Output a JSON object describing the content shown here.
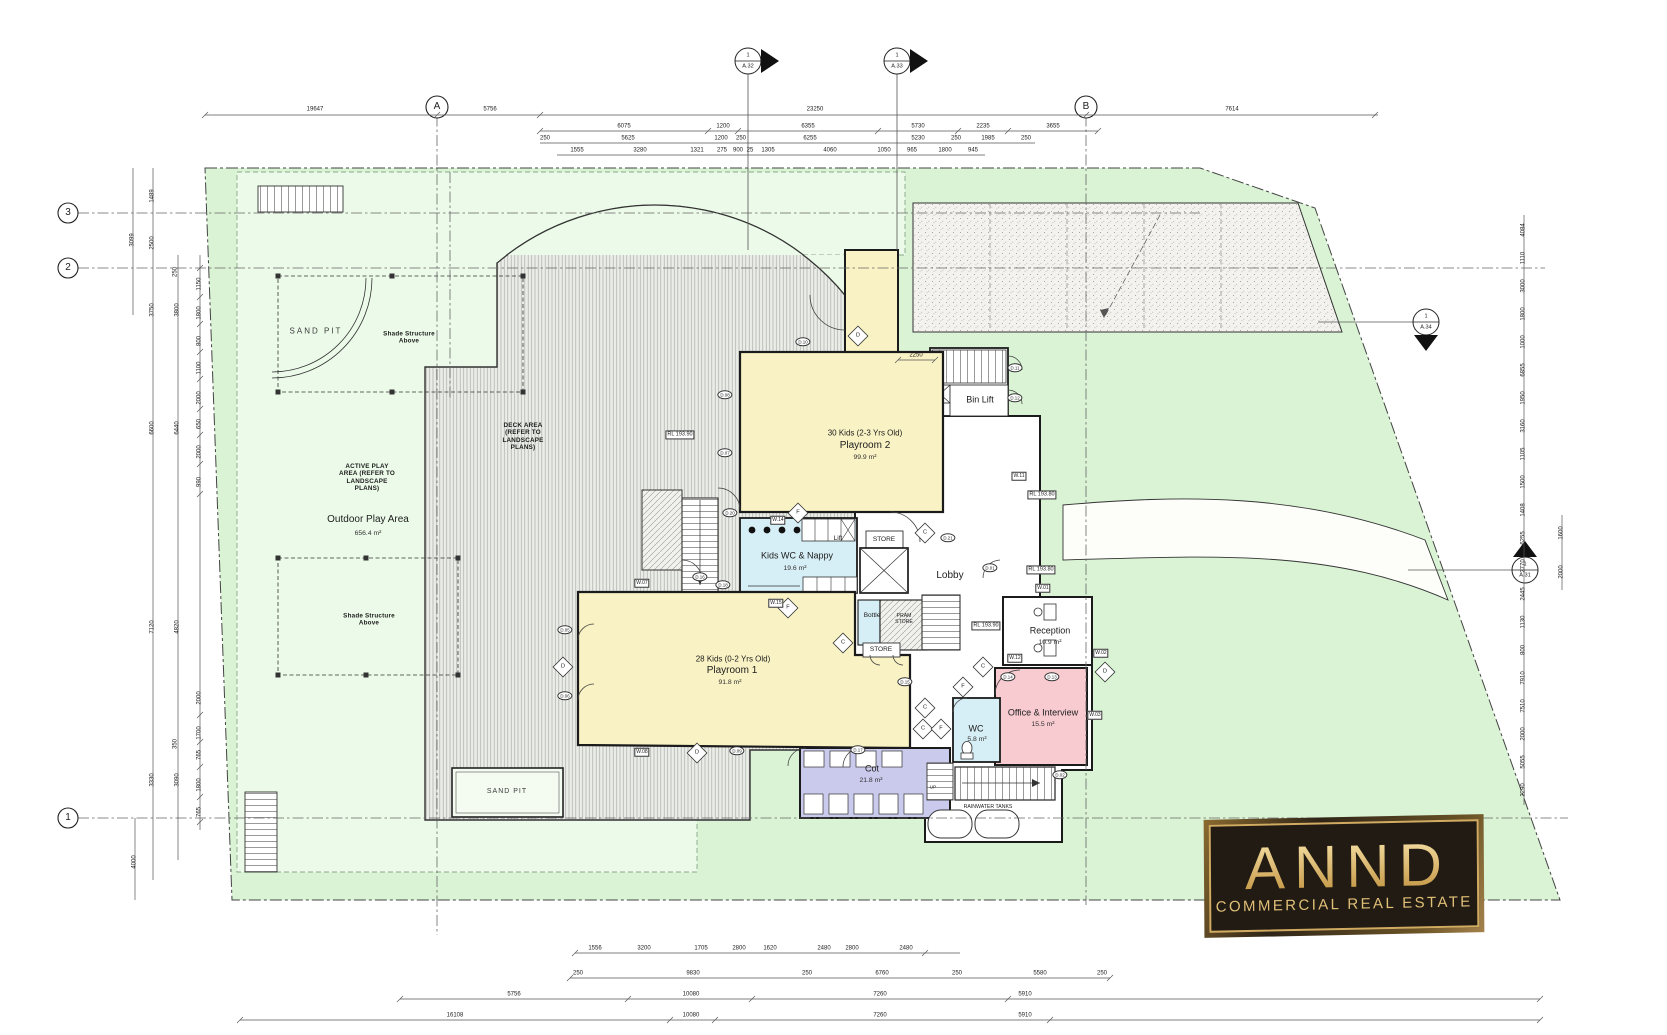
{
  "title": "Childcare centre ground floor plan",
  "logo": {
    "title": "ANND",
    "subtitle": "COMMERCIAL REAL ESTATE"
  },
  "colors": {
    "site_green": "#d9f3d4",
    "play_green": "#ecfbe9",
    "room_yellow": "#f9f2c4",
    "room_blue": "#d6eef5",
    "room_purple": "#cacaec",
    "room_pink": "#f7cbd0",
    "wall": "#1b1b1b",
    "logo_gold": "#d2ab62",
    "logo_bg": "#211b13"
  },
  "layers": {
    "grid_labels": [
      {
        "t": "A",
        "x": 437,
        "y": 107
      },
      {
        "t": "B",
        "x": 1086,
        "y": 107
      },
      {
        "t": "3",
        "x": 68,
        "y": 213
      },
      {
        "t": "2",
        "x": 68,
        "y": 268
      },
      {
        "t": "1",
        "x": 68,
        "y": 818
      }
    ],
    "section_markers": [
      {
        "t": "1",
        "x": 748,
        "y": 56
      },
      {
        "t": "A.32",
        "x": 748,
        "y": 67
      },
      {
        "t": "1",
        "x": 897,
        "y": 56
      },
      {
        "t": "A.33",
        "x": 897,
        "y": 67
      },
      {
        "t": "1",
        "x": 1426,
        "y": 317
      },
      {
        "t": "A.34",
        "x": 1426,
        "y": 328
      },
      {
        "t": "1",
        "x": 1525,
        "y": 565
      },
      {
        "t": "A.31",
        "x": 1525,
        "y": 576
      }
    ],
    "room_labels": [
      {
        "t": "30 Kids (2-3 Yrs Old)",
        "x": 865,
        "y": 433,
        "c": "rs2"
      },
      {
        "t": "Playroom 2",
        "x": 865,
        "y": 446,
        "c": "rt"
      },
      {
        "t": "99.9 m²",
        "x": 865,
        "y": 458,
        "c": "rs"
      },
      {
        "t": "Kids WC & Nappy",
        "x": 797,
        "y": 556,
        "c": "rt2"
      },
      {
        "t": "19.6 m²",
        "x": 795,
        "y": 569,
        "c": "rs"
      },
      {
        "t": "28 Kids (0-2 Yrs Old)",
        "x": 733,
        "y": 659,
        "c": "rs2"
      },
      {
        "t": "Playroom 1",
        "x": 732,
        "y": 671,
        "c": "rt"
      },
      {
        "t": "91.8 m²",
        "x": 730,
        "y": 683,
        "c": "rs"
      },
      {
        "t": "Lobby",
        "x": 950,
        "y": 576,
        "c": "rt"
      },
      {
        "t": "Reception",
        "x": 1050,
        "y": 631,
        "c": "rt2"
      },
      {
        "t": "10.9 m²",
        "x": 1050,
        "y": 643,
        "c": "rs"
      },
      {
        "t": "Office & Interview",
        "x": 1043,
        "y": 713,
        "c": "rt2"
      },
      {
        "t": "15.5 m²",
        "x": 1043,
        "y": 725,
        "c": "rs"
      },
      {
        "t": "WC",
        "x": 976,
        "y": 729,
        "c": "rt2"
      },
      {
        "t": "5.8 m²",
        "x": 977,
        "y": 740,
        "c": "rs"
      },
      {
        "t": "Cot",
        "x": 872,
        "y": 769,
        "c": "rt2"
      },
      {
        "t": "21.8 m²",
        "x": 871,
        "y": 781,
        "c": "rs"
      },
      {
        "t": "Bin Lift",
        "x": 980,
        "y": 400,
        "c": "rt2"
      },
      {
        "t": "Outdoor Play Area",
        "x": 368,
        "y": 520,
        "c": "rt"
      },
      {
        "t": "656.4 m²",
        "x": 368,
        "y": 534,
        "c": "rs"
      }
    ],
    "small_labels": [
      {
        "t": "SAND PIT",
        "x": 316,
        "y": 331,
        "c": "cap",
        "n": "sand-pit-label"
      },
      {
        "t": "SAND PIT",
        "x": 507,
        "y": 792,
        "c": "cap6",
        "n": "sand-pit-label"
      },
      {
        "t": "Shade Structure\nAbove",
        "x": 409,
        "y": 338,
        "c": "tb"
      },
      {
        "t": "Shade Structure\nAbove",
        "x": 369,
        "y": 620,
        "c": "tb"
      },
      {
        "t": "ACTIVE PLAY\nAREA (REFER TO\nLANDSCAPE\nPLANS)",
        "x": 367,
        "y": 478,
        "c": "tb"
      },
      {
        "t": "DECK AREA\n(REFER TO\nLANDSCAPE\nPLANS)",
        "x": 523,
        "y": 437,
        "c": "tb"
      },
      {
        "t": "STORE",
        "x": 884,
        "y": 540,
        "c": "tiny6"
      },
      {
        "t": "STORE",
        "x": 881,
        "y": 650,
        "c": "tiny6"
      },
      {
        "t": "PRAM\nSTORE",
        "x": 904,
        "y": 619,
        "c": "tiny5"
      },
      {
        "t": "Bottle",
        "x": 872,
        "y": 616,
        "c": "tiny6"
      },
      {
        "t": "Lift",
        "x": 838,
        "y": 539,
        "c": "tiny6"
      },
      {
        "t": "UP",
        "x": 933,
        "y": 787,
        "c": "tiny4"
      },
      {
        "t": "RAINWATER TANKS",
        "x": 988,
        "y": 807,
        "c": "tiny5"
      }
    ],
    "rl_levels": [
      {
        "t": "RL 193.90",
        "x": 680,
        "y": 435
      },
      {
        "t": "RL 193.80",
        "x": 1042,
        "y": 495
      },
      {
        "t": "RL 193.80",
        "x": 1041,
        "y": 570
      },
      {
        "t": "RL 193.90",
        "x": 986,
        "y": 626
      }
    ],
    "wall_tags": [
      {
        "t": "W.14",
        "x": 778,
        "y": 520
      },
      {
        "t": "W.15",
        "x": 776,
        "y": 603
      },
      {
        "t": "W.01",
        "x": 1043,
        "y": 588
      },
      {
        "t": "W.02",
        "x": 1101,
        "y": 653
      },
      {
        "t": "W.12",
        "x": 1015,
        "y": 658
      },
      {
        "t": "W.11",
        "x": 1019,
        "y": 476
      },
      {
        "t": "W.03",
        "x": 1095,
        "y": 715
      },
      {
        "t": "W.07",
        "x": 642,
        "y": 583
      },
      {
        "t": "W.08",
        "x": 642,
        "y": 752
      }
    ],
    "door_tags": [
      {
        "t": "D.10",
        "x": 803,
        "y": 342
      },
      {
        "t": "D.08",
        "x": 725,
        "y": 395
      },
      {
        "t": "D.07",
        "x": 725,
        "y": 453
      },
      {
        "t": "D.20",
        "x": 730,
        "y": 513
      },
      {
        "t": "D.16",
        "x": 700,
        "y": 577
      },
      {
        "t": "D.18",
        "x": 723,
        "y": 585
      },
      {
        "t": "D.05",
        "x": 565,
        "y": 630
      },
      {
        "t": "D.06",
        "x": 565,
        "y": 696
      },
      {
        "t": "D.09",
        "x": 737,
        "y": 751
      },
      {
        "t": "D.17",
        "x": 858,
        "y": 750
      },
      {
        "t": "D.21",
        "x": 948,
        "y": 538
      },
      {
        "t": "D.01",
        "x": 990,
        "y": 568
      },
      {
        "t": "D.11",
        "x": 1015,
        "y": 368
      },
      {
        "t": "D.12",
        "x": 1015,
        "y": 398
      },
      {
        "t": "D.14",
        "x": 1008,
        "y": 677
      },
      {
        "t": "D.13",
        "x": 1052,
        "y": 677
      },
      {
        "t": "D.02",
        "x": 1060,
        "y": 775
      },
      {
        "t": "D.15",
        "x": 905,
        "y": 682
      }
    ],
    "diamond_markers": [
      {
        "t": "D",
        "x": 858,
        "y": 336
      },
      {
        "t": "F",
        "x": 798,
        "y": 513
      },
      {
        "t": "F",
        "x": 788,
        "y": 608
      },
      {
        "t": "C",
        "x": 925,
        "y": 533
      },
      {
        "t": "C",
        "x": 983,
        "y": 667
      },
      {
        "t": "F",
        "x": 963,
        "y": 687
      },
      {
        "t": "C",
        "x": 925,
        "y": 708
      },
      {
        "t": "C",
        "x": 923,
        "y": 729
      },
      {
        "t": "F",
        "x": 941,
        "y": 729
      },
      {
        "t": "D",
        "x": 1105,
        "y": 672
      },
      {
        "t": "D",
        "x": 563,
        "y": 667
      },
      {
        "t": "D",
        "x": 697,
        "y": 753
      },
      {
        "t": "C",
        "x": 843,
        "y": 643
      }
    ],
    "dims_top": [
      {
        "t": "19647",
        "x": 315,
        "y": 110
      },
      {
        "t": "5756",
        "x": 490,
        "y": 110
      },
      {
        "t": "23250",
        "x": 815,
        "y": 110
      },
      {
        "t": "7614",
        "x": 1232,
        "y": 110
      },
      {
        "t": "6075",
        "x": 624,
        "y": 127
      },
      {
        "t": "1200",
        "x": 723,
        "y": 127
      },
      {
        "t": "6355",
        "x": 808,
        "y": 127
      },
      {
        "t": "5730",
        "x": 918,
        "y": 127
      },
      {
        "t": "2235",
        "x": 983,
        "y": 127
      },
      {
        "t": "3655",
        "x": 1053,
        "y": 127
      },
      {
        "t": "250",
        "x": 545,
        "y": 139
      },
      {
        "t": "5625",
        "x": 628,
        "y": 139
      },
      {
        "t": "1200",
        "x": 721,
        "y": 139
      },
      {
        "t": "250",
        "x": 741,
        "y": 139
      },
      {
        "t": "6255",
        "x": 810,
        "y": 139
      },
      {
        "t": "5230",
        "x": 918,
        "y": 139
      },
      {
        "t": "250",
        "x": 956,
        "y": 139
      },
      {
        "t": "1985",
        "x": 988,
        "y": 139
      },
      {
        "t": "250",
        "x": 1026,
        "y": 139
      },
      {
        "t": "1555",
        "x": 577,
        "y": 151
      },
      {
        "t": "3280",
        "x": 640,
        "y": 151
      },
      {
        "t": "1321",
        "x": 697,
        "y": 151
      },
      {
        "t": "275",
        "x": 722,
        "y": 151
      },
      {
        "t": "900",
        "x": 738,
        "y": 151
      },
      {
        "t": "25",
        "x": 750,
        "y": 151
      },
      {
        "t": "1305",
        "x": 768,
        "y": 151
      },
      {
        "t": "4060",
        "x": 830,
        "y": 151
      },
      {
        "t": "1050",
        "x": 884,
        "y": 151
      },
      {
        "t": "965",
        "x": 912,
        "y": 151
      },
      {
        "t": "1800",
        "x": 945,
        "y": 151
      },
      {
        "t": "945",
        "x": 973,
        "y": 151
      },
      {
        "t": "2250",
        "x": 916,
        "y": 356
      }
    ],
    "dims_bottom": [
      {
        "t": "1556",
        "x": 595,
        "y": 949
      },
      {
        "t": "3200",
        "x": 644,
        "y": 949
      },
      {
        "t": "1705",
        "x": 701,
        "y": 949
      },
      {
        "t": "2800",
        "x": 739,
        "y": 949
      },
      {
        "t": "1620",
        "x": 770,
        "y": 949
      },
      {
        "t": "2480",
        "x": 824,
        "y": 949
      },
      {
        "t": "2800",
        "x": 852,
        "y": 949
      },
      {
        "t": "2480",
        "x": 906,
        "y": 949
      },
      {
        "t": "250",
        "x": 578,
        "y": 974
      },
      {
        "t": "9830",
        "x": 693,
        "y": 974
      },
      {
        "t": "250",
        "x": 807,
        "y": 974
      },
      {
        "t": "6760",
        "x": 882,
        "y": 974
      },
      {
        "t": "250",
        "x": 957,
        "y": 974
      },
      {
        "t": "5580",
        "x": 1040,
        "y": 974
      },
      {
        "t": "250",
        "x": 1102,
        "y": 974
      },
      {
        "t": "5756",
        "x": 514,
        "y": 995
      },
      {
        "t": "10080",
        "x": 691,
        "y": 995
      },
      {
        "t": "7260",
        "x": 880,
        "y": 995
      },
      {
        "t": "5910",
        "x": 1025,
        "y": 995
      },
      {
        "t": "16108",
        "x": 455,
        "y": 1016
      },
      {
        "t": "10080",
        "x": 691,
        "y": 1016
      },
      {
        "t": "7260",
        "x": 880,
        "y": 1016
      },
      {
        "t": "5910",
        "x": 1025,
        "y": 1016
      }
    ],
    "dims_left": [
      {
        "t": "3099",
        "x": 133,
        "y": 240
      },
      {
        "t": "1489",
        "x": 153,
        "y": 196
      },
      {
        "t": "2500",
        "x": 153,
        "y": 243
      },
      {
        "t": "3750",
        "x": 153,
        "y": 310
      },
      {
        "t": "6600",
        "x": 153,
        "y": 428
      },
      {
        "t": "7120",
        "x": 153,
        "y": 627
      },
      {
        "t": "3330",
        "x": 153,
        "y": 780
      },
      {
        "t": "4000",
        "x": 135,
        "y": 862
      },
      {
        "t": "250",
        "x": 176,
        "y": 272
      },
      {
        "t": "3800",
        "x": 178,
        "y": 310
      },
      {
        "t": "6440",
        "x": 178,
        "y": 428
      },
      {
        "t": "4820",
        "x": 178,
        "y": 627
      },
      {
        "t": "350",
        "x": 176,
        "y": 744
      },
      {
        "t": "3090",
        "x": 178,
        "y": 780
      },
      {
        "t": "1150",
        "x": 200,
        "y": 284
      },
      {
        "t": "1800",
        "x": 200,
        "y": 313
      },
      {
        "t": "800",
        "x": 200,
        "y": 341
      },
      {
        "t": "1100",
        "x": 200,
        "y": 368
      },
      {
        "t": "2000",
        "x": 200,
        "y": 398
      },
      {
        "t": "650",
        "x": 200,
        "y": 424
      },
      {
        "t": "2000",
        "x": 200,
        "y": 452
      },
      {
        "t": "990",
        "x": 200,
        "y": 482
      },
      {
        "t": "2000",
        "x": 200,
        "y": 698
      },
      {
        "t": "1700",
        "x": 200,
        "y": 733
      },
      {
        "t": "765",
        "x": 200,
        "y": 755
      },
      {
        "t": "1800",
        "x": 200,
        "y": 785
      },
      {
        "t": "765",
        "x": 200,
        "y": 812
      }
    ],
    "dims_right": [
      {
        "t": "4084",
        "x": 1524,
        "y": 230
      },
      {
        "t": "1110",
        "x": 1524,
        "y": 258
      },
      {
        "t": "3000",
        "x": 1524,
        "y": 286
      },
      {
        "t": "1800",
        "x": 1524,
        "y": 314
      },
      {
        "t": "1000",
        "x": 1524,
        "y": 342
      },
      {
        "t": "6855",
        "x": 1524,
        "y": 370
      },
      {
        "t": "1950",
        "x": 1524,
        "y": 398
      },
      {
        "t": "3160",
        "x": 1524,
        "y": 426
      },
      {
        "t": "1105",
        "x": 1524,
        "y": 454
      },
      {
        "t": "1500",
        "x": 1524,
        "y": 482
      },
      {
        "t": "1408",
        "x": 1524,
        "y": 510
      },
      {
        "t": "6255",
        "x": 1524,
        "y": 538
      },
      {
        "t": "2770",
        "x": 1524,
        "y": 566
      },
      {
        "t": "2445",
        "x": 1524,
        "y": 594
      },
      {
        "t": "1130",
        "x": 1524,
        "y": 622
      },
      {
        "t": "800",
        "x": 1524,
        "y": 650
      },
      {
        "t": "7910",
        "x": 1524,
        "y": 678
      },
      {
        "t": "7510",
        "x": 1524,
        "y": 706
      },
      {
        "t": "2000",
        "x": 1524,
        "y": 734
      },
      {
        "t": "5055",
        "x": 1524,
        "y": 762
      },
      {
        "t": "2290",
        "x": 1524,
        "y": 790
      },
      {
        "t": "1600",
        "x": 1562,
        "y": 533
      },
      {
        "t": "2000",
        "x": 1562,
        "y": 572
      }
    ]
  }
}
